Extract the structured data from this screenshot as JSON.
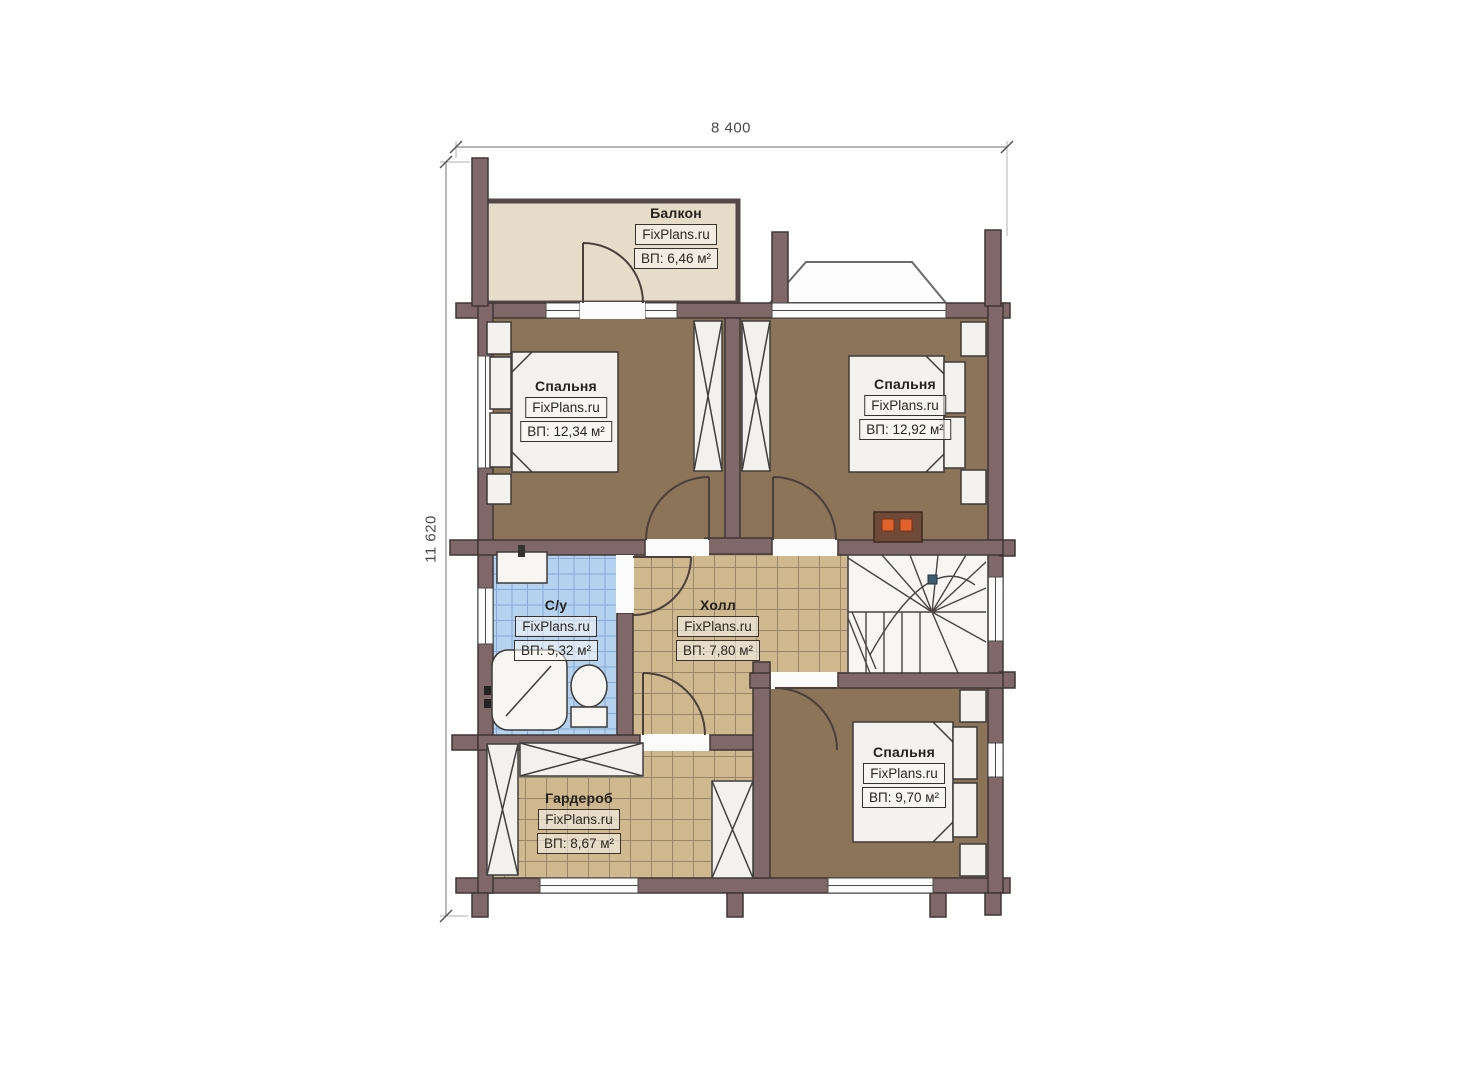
{
  "page": {
    "type": "architectural floor plan (second storey of a log house)",
    "background": "#ffffff"
  },
  "brand": "FixPlans.ru",
  "dimensions": {
    "width_label": "8 400",
    "height_label": "11 620"
  },
  "rooms": [
    {
      "id": "balcony",
      "name": "Балкон",
      "brand": "FixPlans.ru",
      "area": "ВП: 6,46 м²"
    },
    {
      "id": "bedroom-top-left",
      "name": "Спальня",
      "brand": "FixPlans.ru",
      "area": "ВП: 12,34 м²"
    },
    {
      "id": "bedroom-top-right",
      "name": "Спальня",
      "brand": "FixPlans.ru",
      "area": "ВП: 12,92 м²"
    },
    {
      "id": "bathroom",
      "name": "С/у",
      "brand": "FixPlans.ru",
      "area": "ВП: 5,32 м²"
    },
    {
      "id": "hall",
      "name": "Холл",
      "brand": "FixPlans.ru",
      "area": "ВП: 7,80 м²"
    },
    {
      "id": "wardrobe",
      "name": "Гардероб",
      "brand": "FixPlans.ru",
      "area": "ВП: 8,67 м²"
    },
    {
      "id": "bedroom-bottom-right",
      "name": "Спальня",
      "brand": "FixPlans.ru",
      "area": "ВП: 9,70 м²"
    }
  ],
  "icons": {
    "beds": "bed-icon (3 double beds with pillows)",
    "wardrobes": "wardrobe-icon (rectangles with X cross)",
    "bathroom": [
      "sink-icon",
      "shower-icon",
      "toilet-icon"
    ],
    "stairs": "winder-staircase-icon",
    "stove": "stove-icon (two orange burners)",
    "bay": "bay-window-icon"
  },
  "colors": {
    "wall": "#806868",
    "wall_outline": "#3f3636",
    "bedroom_floor": "#8b7457",
    "tile_floor": "#cfb88e",
    "bath_tile": "#b5d2f0",
    "balcony_floor": "#e6dcc9",
    "stair_fill": "#f7f6f3",
    "stove_accent": "#e2622e",
    "dimension_text": "#4a4a4a"
  }
}
